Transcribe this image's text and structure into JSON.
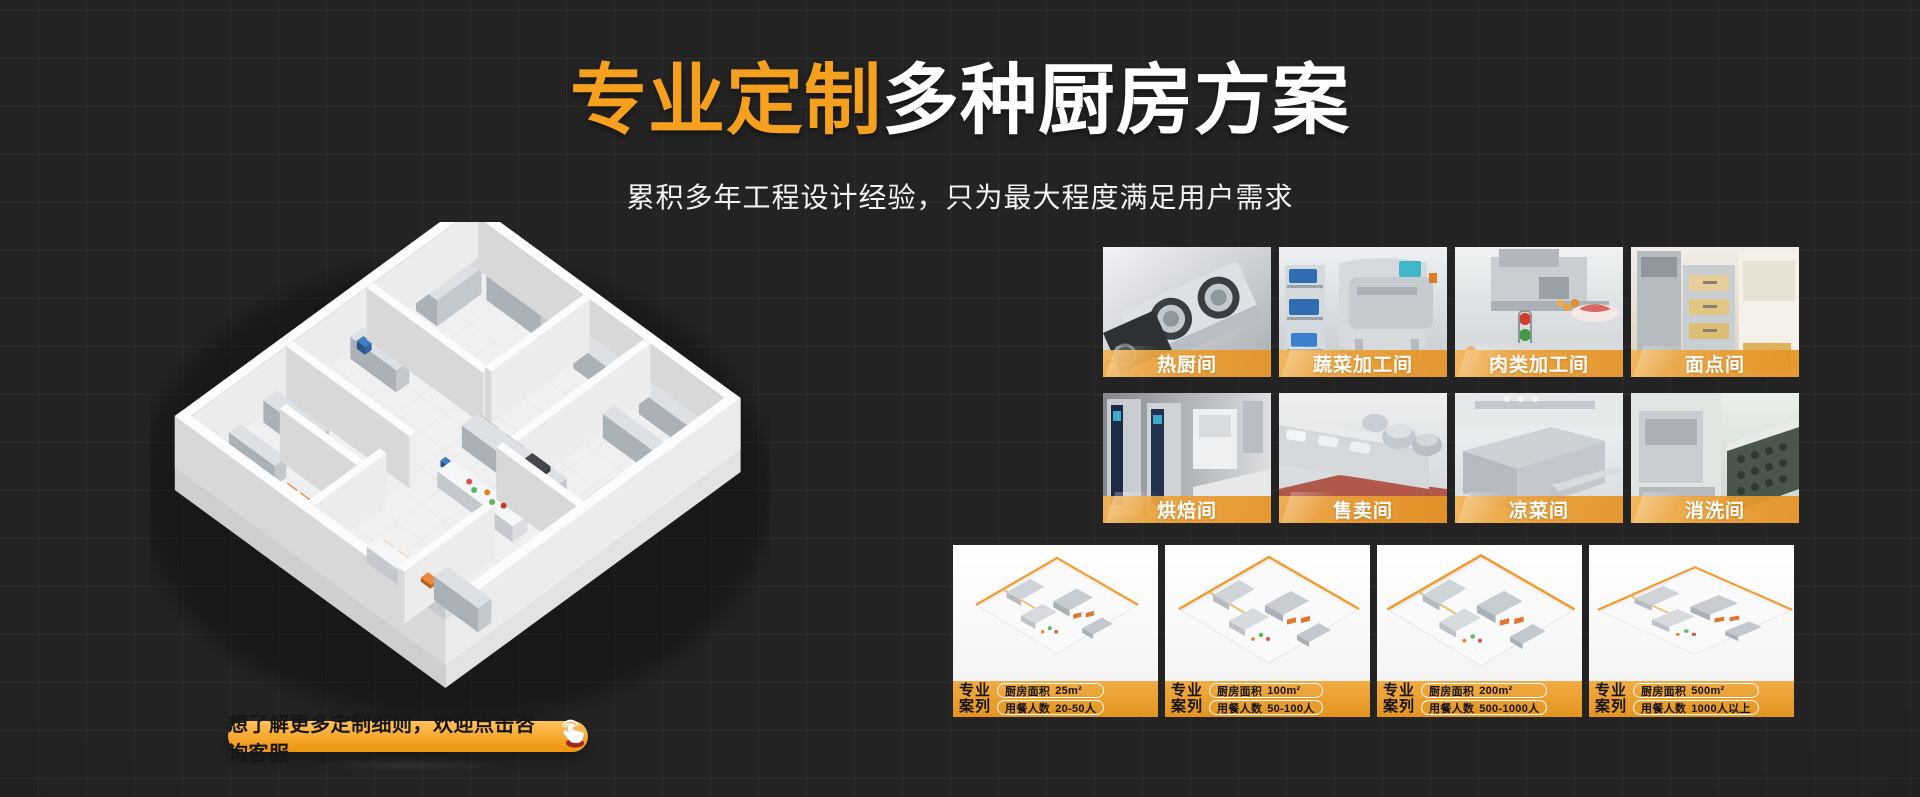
{
  "hero": {
    "title_highlight": "专业定制",
    "title_rest": "多种厨房方案",
    "subtitle": "累积多年工程设计经验，只为最大程度满足用户需求"
  },
  "rooms": {
    "items": [
      {
        "label": "热厨间"
      },
      {
        "label": "蔬菜加工间"
      },
      {
        "label": "肉类加工间"
      },
      {
        "label": "面点间"
      },
      {
        "label": "烘焙间"
      },
      {
        "label": "售卖间"
      },
      {
        "label": "凉菜间"
      },
      {
        "label": "消洗间"
      }
    ]
  },
  "cases": {
    "badge_line1": "专业",
    "badge_line2": "案列",
    "area_label": "厨房面积",
    "diners_label": "用餐人数",
    "items": [
      {
        "area": "25m²",
        "diners": "20-50人"
      },
      {
        "area": "100m²",
        "diners": "50-100人"
      },
      {
        "area": "200m²",
        "diners": "500-1000人"
      },
      {
        "area": "500m²",
        "diners": "1000人以上"
      }
    ]
  },
  "cta": {
    "label": "想了解更多定制细则，欢迎点击咨询客服",
    "icon": "click-hand-icon"
  },
  "colors": {
    "background": "#232323",
    "grid_line": "#2d2d2e",
    "accent_orange": "#F5A01E",
    "label_bar_orange": "#ECA14A",
    "cta_gradient_top": "#FFC25C",
    "cta_gradient_bottom": "#F09A14"
  }
}
